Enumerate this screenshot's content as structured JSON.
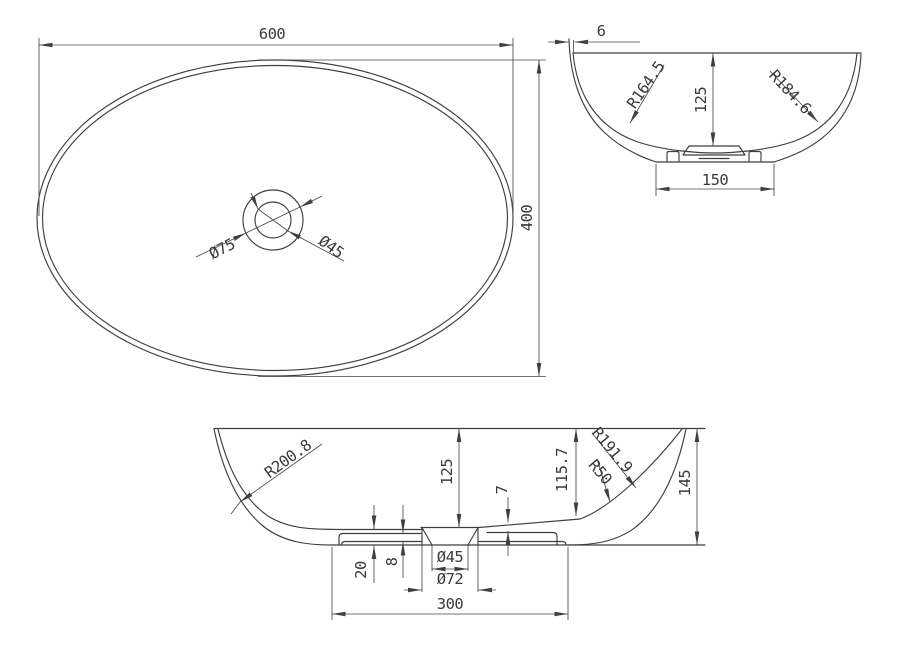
{
  "drawing": {
    "type": "technical-cad-drawing",
    "subject": "oval countertop wash basin, three orthographic views",
    "line_color": "#3f3f3f",
    "background_color": "#ffffff",
    "views": {
      "top": {
        "name": "plan view",
        "width": "600",
        "height": "400",
        "outer": "Ø75",
        "inner": "Ø45"
      },
      "end": {
        "name": "end section view",
        "wall": "6",
        "r_inner": "R164.5",
        "r_outer": "R184.6",
        "depth": "125",
        "base": "150"
      },
      "long": {
        "name": "long section view",
        "r_left": "R200.8",
        "depth": "125",
        "step": "7",
        "inner_h": "115.7",
        "r_right": "R191.9",
        "fillet": "R50",
        "height": "145",
        "thick": "20",
        "recess": "8",
        "drain": "Ø45",
        "bore": "Ø72",
        "base": "300"
      }
    }
  }
}
